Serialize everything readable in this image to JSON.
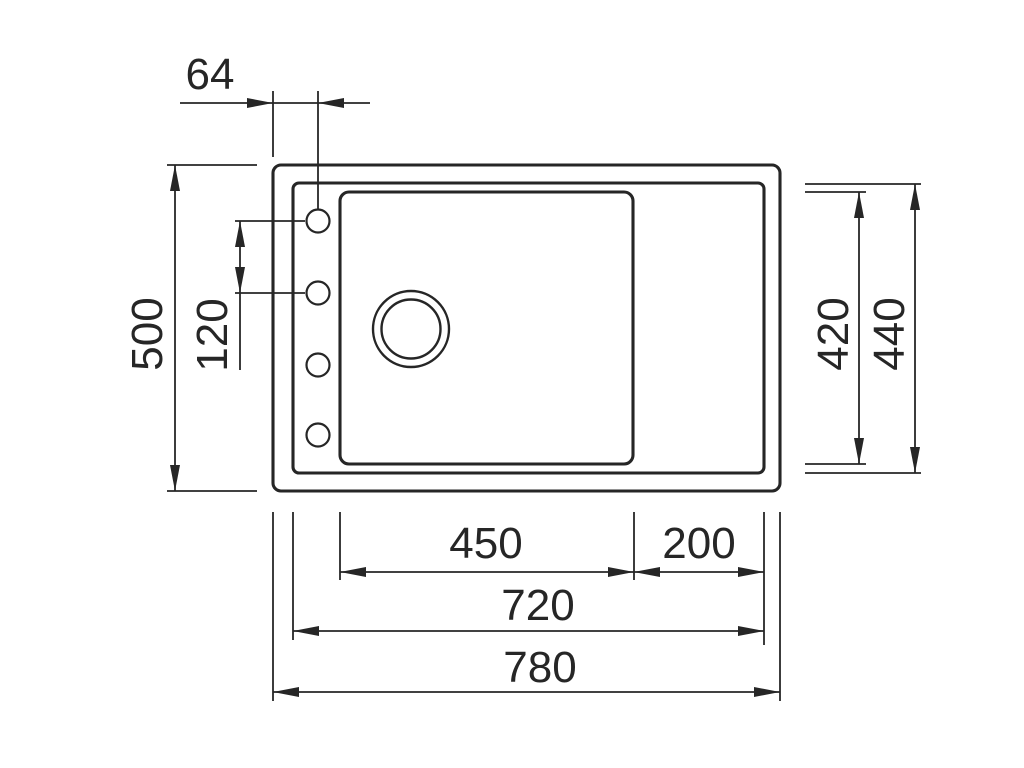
{
  "drawing": {
    "background_color": "#ffffff",
    "line_color": "#262626",
    "dimensions": {
      "faucet_hole_offset": "64",
      "overall_depth": "500",
      "faucet_hole_spacing": "120",
      "bowl_depth": "420",
      "inner_depth": "440",
      "bowl_width": "450",
      "drainboard_width": "200",
      "inner_width": "720",
      "overall_width": "780"
    }
  }
}
